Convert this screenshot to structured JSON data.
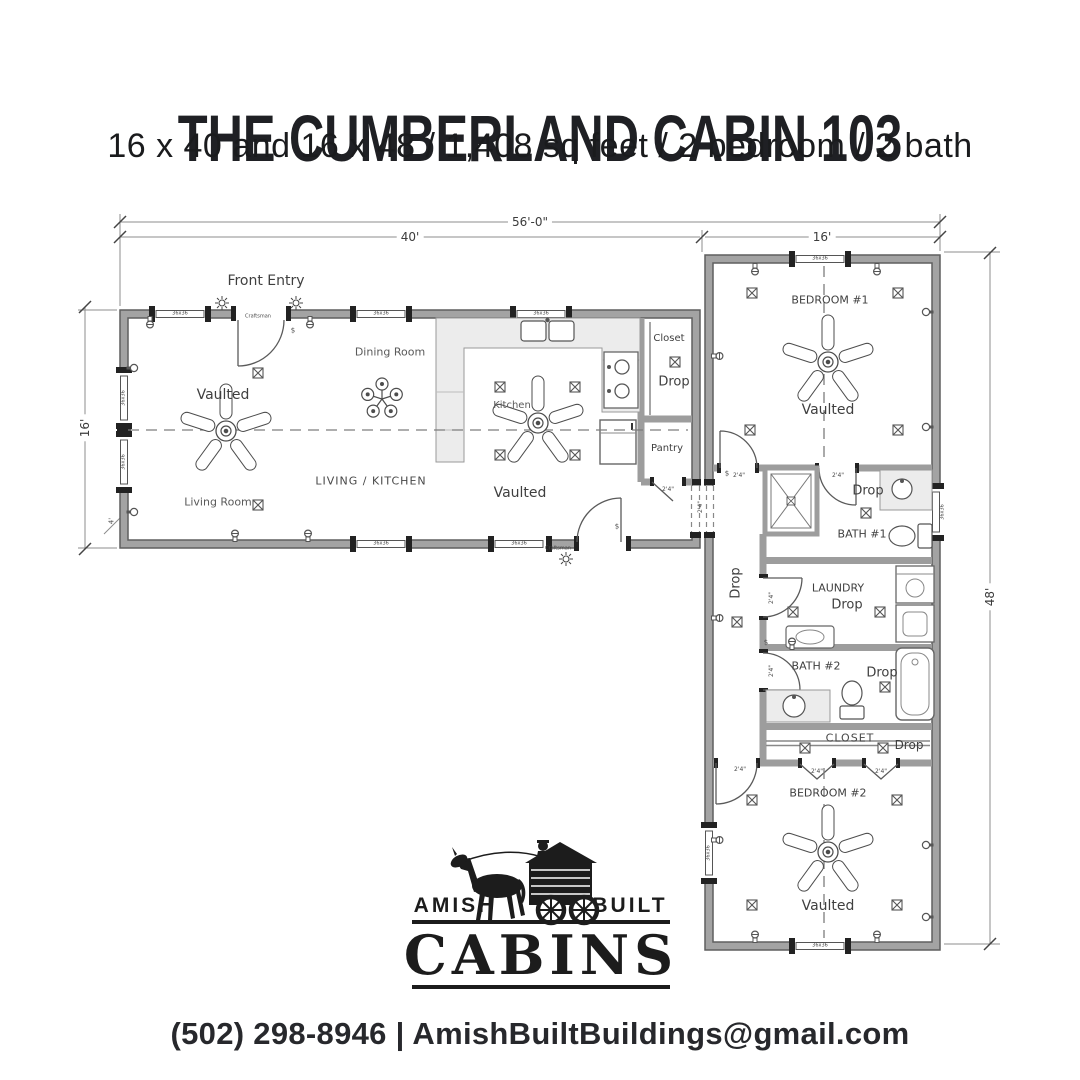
{
  "header": {
    "title": "THE CUMBERLAND CABIN 103",
    "subtitle": "16 x 40 and 16 x 48 / 1,408 sq feet / 2 bedroom / 2 bath"
  },
  "plan": {
    "dimensions": {
      "total_width": "56'-0\"",
      "left_width": "40'",
      "right_width": "16'",
      "left_height": "16'",
      "right_height": "48'",
      "porch": "4'"
    },
    "rooms": {
      "front_entry": "Front Entry",
      "dining": "Dining Room",
      "kitchen": "Kitchen",
      "living_room": "Living Room",
      "living_kitchen": "LIVING / KITCHEN",
      "closet_top": "Closet",
      "pantry": "Pantry",
      "bedroom1": "BEDROOM #1",
      "bath1": "BATH #1",
      "laundry": "LAUNDRY",
      "bath2": "BATH #2",
      "closet2": "CLOSET",
      "bedroom2": "BEDROOM #2"
    },
    "labels": {
      "vaulted": "Vaulted",
      "drop": "Drop",
      "window": "36x36",
      "door_size": "2'4\"",
      "door_type": "Craftsman",
      "switch": "$"
    }
  },
  "logo": {
    "amish": "AMISH",
    "built": "BUILT",
    "cabins": "CABINS"
  },
  "footer": {
    "phone": "(502) 298-8946",
    "separator": "|",
    "email": "AmishBuiltBuildings@gmail.com"
  }
}
